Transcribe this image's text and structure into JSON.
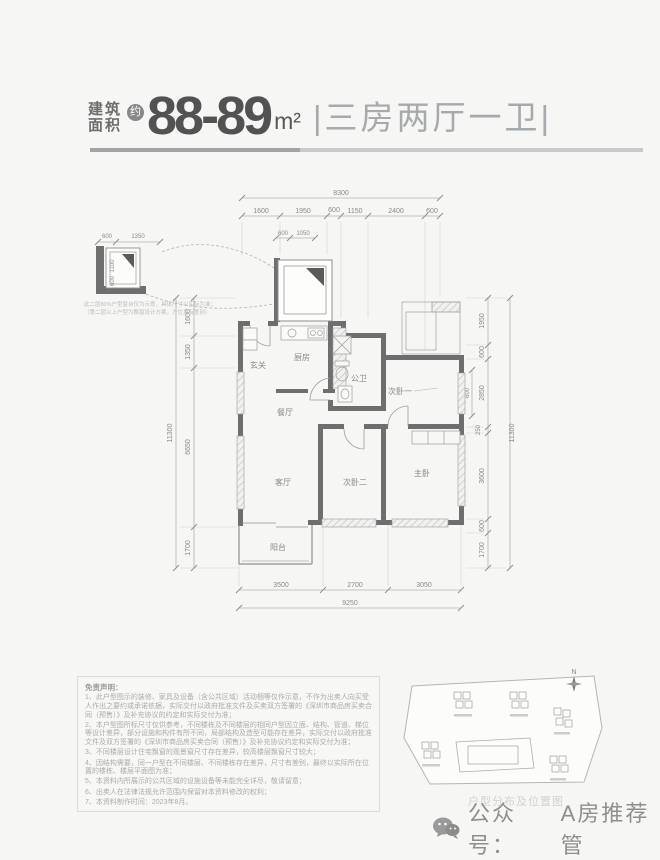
{
  "header": {
    "area_label_line1": "建筑",
    "area_label_line2": "面积",
    "approx_badge": "约",
    "area_value": "88-89",
    "area_unit": "m²",
    "type_text": "|三房两厅一卫|"
  },
  "plan": {
    "dims": {
      "top_total": "8300",
      "top_segments": [
        "1600",
        "1950",
        "600",
        "1150",
        "2400",
        "600"
      ],
      "bay_segments": [
        "600",
        "1050"
      ],
      "bay_height_labels": [
        "1100",
        "600"
      ],
      "left_total": "11300",
      "left_segments": [
        "1600",
        "1350",
        "6650",
        "1700"
      ],
      "right_total": "11300",
      "right_segments": [
        "1950",
        "600",
        "2850",
        "250",
        "3600",
        "600",
        "1700"
      ],
      "extra_window": "600",
      "bottom_segments": [
        "3500",
        "2700",
        "3050"
      ],
      "bottom_total": "9250"
    },
    "rooms": {
      "entry": "玄关",
      "kitchen": "厨房",
      "bath": "公卫",
      "dining": "餐厅",
      "living": "客厅",
      "balcony": "阳台",
      "bedroom1": "次卧一",
      "bedroom2": "次卧二",
      "master": "主卧"
    },
    "inset": {
      "width_segments": [
        "600",
        "1350"
      ],
      "height_labels": [
        "1100",
        "600"
      ],
      "note_line1": "此二层80%户型窗台仅为示意，具体尺寸以实际为准；",
      "note_line2": "（第二层以上户型为飘窗设计方案，方位另有差别）"
    }
  },
  "disclaimer": {
    "title": "免责声明：",
    "lines": [
      "1、此户型图示的装修、家具及设备（含公共区域）活动梱等仅作示意，不作为出卖人向买受人作出之要约或承诺依据，实际交付以政府批准文件及买卖双方签署的《深圳市商品房买卖合同（预售）》及补充协议的约定和实际交付为准；",
      "2、本户型图所标尺寸仅供参考，不同楼栋及不同楼层的相同户型因立面、结构、管道、梯位等设计差异，部分设施和构件有所不同，局部结构及造型可能存在差异，实际交付以政府批准文件及双方签署的《深圳市商品房买卖合同（预售）》及补充协议约定和实际交付为准；",
      "3、不同楼层设计住宅飘窗的观景窗尺寸存在差异，较高楼层飘窗尺寸较大；",
      "4、因结构需要，同一户型在不同楼层、不同楼栋存在差异，尺寸有差别，最终以实际所在位置的楼栋、楼层平面图为准；",
      "5、本资料内所展示的公共区域的设施设备等未能完全详尽，敬请留意；",
      "6、出卖人在法律法规允许范围内保留对本资料修改的权利；",
      "7、本资料制作时间：2023年8月。"
    ]
  },
  "siteplan": {
    "north_label": "N",
    "caption": "户型分布及位置图"
  },
  "footer": {
    "account_prefix": "公众号：",
    "account_name": "A房推荐管"
  }
}
